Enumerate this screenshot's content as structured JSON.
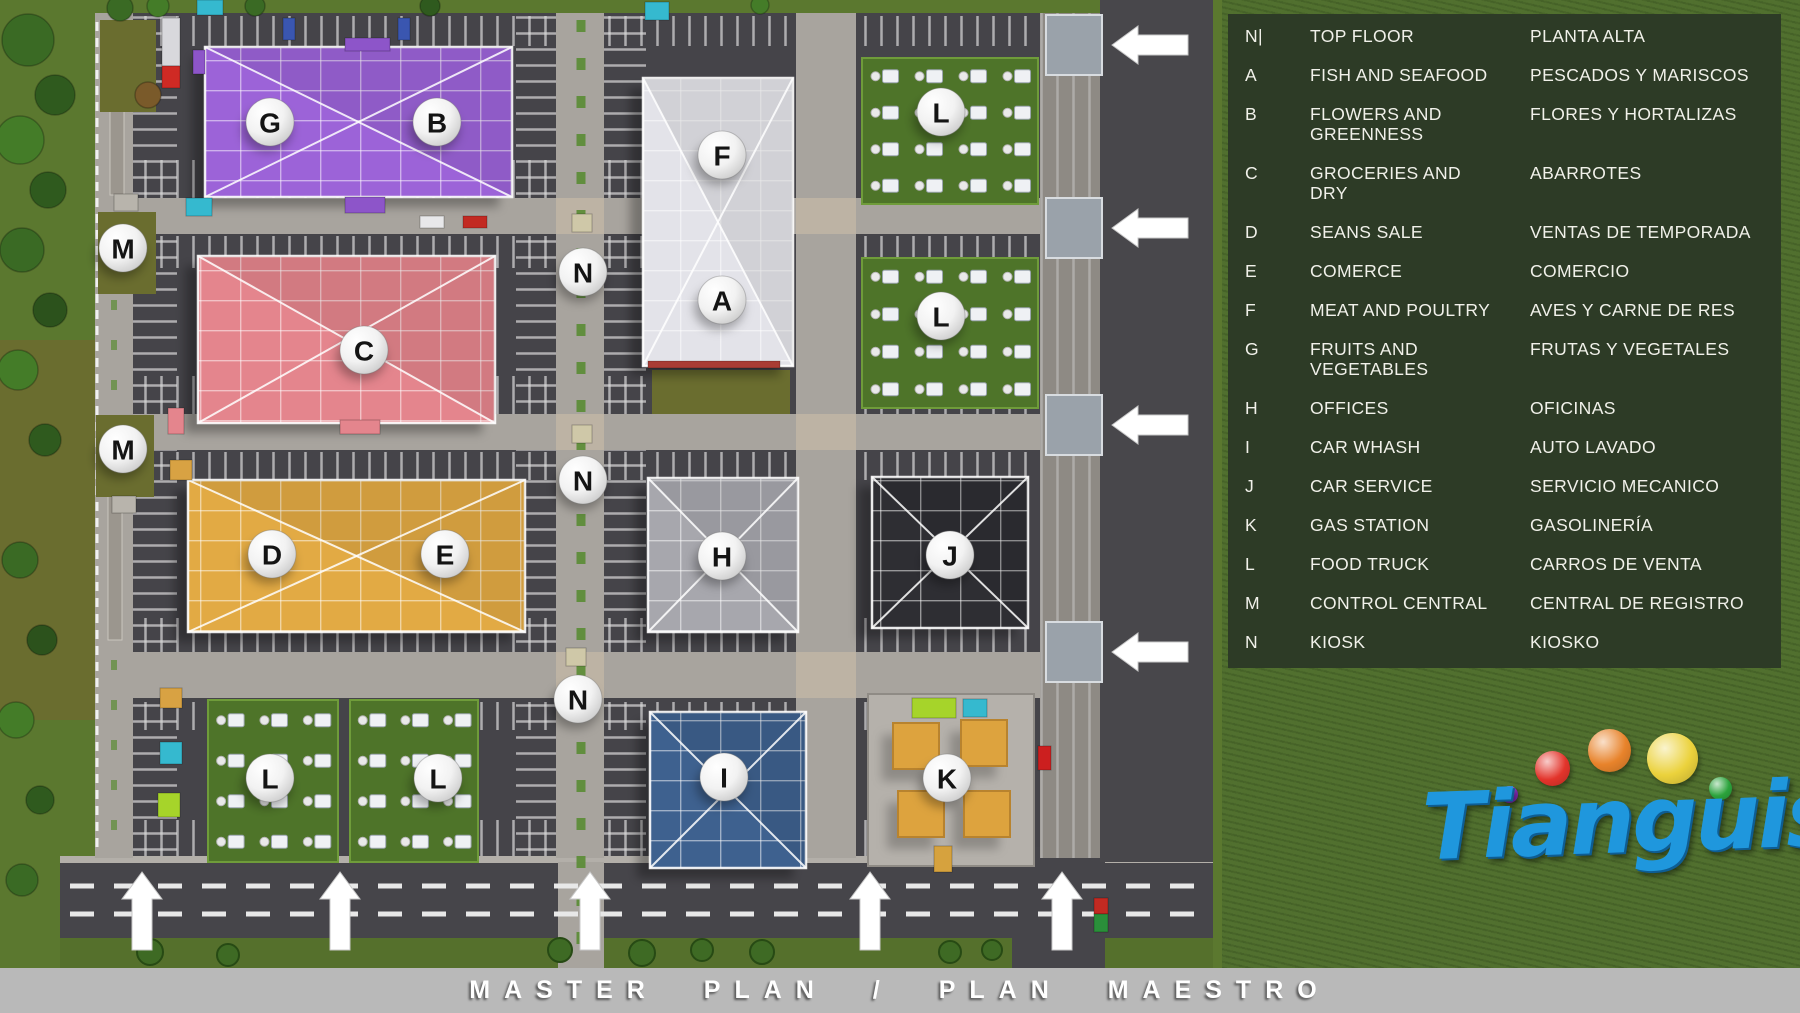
{
  "footer": {
    "title": "MASTER PLAN / PLAN MAESTRO",
    "bar_color": "#b9b9b9"
  },
  "legend": {
    "panel_color": "#2d3b26",
    "text_color": "#f1f1ea",
    "rows": [
      {
        "code": "N|",
        "en": "TOP FLOOR",
        "es": "PLANTA ALTA"
      },
      {
        "code": "A",
        "en": "FISH AND SEAFOOD",
        "es": "PESCADOS Y MARISCOS"
      },
      {
        "code": "B",
        "en": "FLOWERS AND\nGREENNESS",
        "es": "FLORES Y HORTALIZAS"
      },
      {
        "code": "C",
        "en": "GROCERIES AND\nDRY",
        "es": "ABARROTES"
      },
      {
        "code": "D",
        "en": "SEANS SALE",
        "es": "VENTAS DE TEMPORADA"
      },
      {
        "code": "E",
        "en": "COMERCE",
        "es": "COMERCIO"
      },
      {
        "code": "F",
        "en": "MEAT AND POULTRY",
        "es": "AVES Y CARNE DE RES"
      },
      {
        "code": "G",
        "en": "FRUITS AND\nVEGETABLES",
        "es": "FRUTAS Y VEGETALES"
      },
      {
        "code": "H",
        "en": "OFFICES",
        "es": "OFICINAS"
      },
      {
        "code": "I",
        "en": "CAR WHASH",
        "es": "AUTO LAVADO"
      },
      {
        "code": "J",
        "en": "CAR SERVICE",
        "es": "SERVICIO MECANICO"
      },
      {
        "code": "K",
        "en": "GAS STATION",
        "es": "GASOLINERÍA"
      },
      {
        "code": "L",
        "en": "FOOD TRUCK",
        "es": "CARROS DE VENTA"
      },
      {
        "code": "M",
        "en": "CONTROL CENTRAL",
        "es": "CENTRAL DE REGISTRO"
      },
      {
        "code": "N",
        "en": "KIOSK",
        "es": "KIOSKO"
      }
    ]
  },
  "logo": {
    "text": "Tianguis",
    "text_color": "#1f97dd",
    "dots": [
      {
        "name": "purple-dot",
        "color": "#8d2cc4"
      },
      {
        "name": "red-dot",
        "color": "#e3342b"
      },
      {
        "name": "orange-dot",
        "color": "#e8832b"
      },
      {
        "name": "yellow-dot",
        "color": "#ebd23c"
      },
      {
        "name": "green-dot",
        "color": "#2ba33c"
      }
    ]
  },
  "map": {
    "badges": [
      {
        "letter": "G",
        "x": 270,
        "y": 122
      },
      {
        "letter": "B",
        "x": 437,
        "y": 122
      },
      {
        "letter": "F",
        "x": 722,
        "y": 155
      },
      {
        "letter": "L",
        "x": 941,
        "y": 112
      },
      {
        "letter": "M",
        "x": 123,
        "y": 248
      },
      {
        "letter": "N",
        "x": 583,
        "y": 272
      },
      {
        "letter": "A",
        "x": 722,
        "y": 300
      },
      {
        "letter": "L",
        "x": 941,
        "y": 316
      },
      {
        "letter": "C",
        "x": 364,
        "y": 350
      },
      {
        "letter": "M",
        "x": 123,
        "y": 449
      },
      {
        "letter": "N",
        "x": 583,
        "y": 480
      },
      {
        "letter": "D",
        "x": 272,
        "y": 554
      },
      {
        "letter": "E",
        "x": 445,
        "y": 554
      },
      {
        "letter": "H",
        "x": 722,
        "y": 556
      },
      {
        "letter": "J",
        "x": 950,
        "y": 555
      },
      {
        "letter": "N",
        "x": 578,
        "y": 699
      },
      {
        "letter": "L",
        "x": 270,
        "y": 778
      },
      {
        "letter": "L",
        "x": 438,
        "y": 778
      },
      {
        "letter": "I",
        "x": 724,
        "y": 777
      },
      {
        "letter": "K",
        "x": 947,
        "y": 778
      }
    ],
    "buildings": [
      {
        "key": "G-B",
        "color": "#9c63d8",
        "x": 205,
        "y": 47,
        "w": 307,
        "h": 150
      },
      {
        "key": "C",
        "color": "#e4858d",
        "x": 198,
        "y": 256,
        "w": 297,
        "h": 167
      },
      {
        "key": "D-E",
        "color": "#e2aa44",
        "x": 188,
        "y": 480,
        "w": 337,
        "h": 152
      },
      {
        "key": "F-A",
        "color": "#e3e3e9",
        "x": 643,
        "y": 78,
        "w": 150,
        "h": 288
      },
      {
        "key": "H",
        "color": "#a7a7ad",
        "x": 648,
        "y": 478,
        "w": 150,
        "h": 154
      },
      {
        "key": "J",
        "color": "#2e2e33",
        "x": 872,
        "y": 477,
        "w": 156,
        "h": 151
      },
      {
        "key": "I",
        "color": "#3e618f",
        "x": 650,
        "y": 712,
        "w": 156,
        "h": 156
      }
    ],
    "truck_zones": [
      {
        "x": 862,
        "y": 58,
        "w": 176,
        "h": 146,
        "cols": 4,
        "rows": 4
      },
      {
        "x": 862,
        "y": 258,
        "w": 176,
        "h": 150,
        "cols": 4,
        "rows": 4
      },
      {
        "x": 208,
        "y": 700,
        "w": 130,
        "h": 162,
        "cols": 3,
        "rows": 4
      },
      {
        "x": 350,
        "y": 700,
        "w": 128,
        "h": 162,
        "cols": 3,
        "rows": 4
      }
    ],
    "gas_station": {
      "x": 868,
      "y": 694,
      "w": 166,
      "h": 172,
      "canopy_color": "#dda33e"
    },
    "arrows": {
      "right": [
        {
          "x": 1112,
          "y": 45
        },
        {
          "x": 1112,
          "y": 228
        },
        {
          "x": 1112,
          "y": 425
        },
        {
          "x": 1112,
          "y": 652
        }
      ],
      "bottom": [
        {
          "x": 142,
          "y": 950
        },
        {
          "x": 340,
          "y": 950
        },
        {
          "x": 590,
          "y": 950
        },
        {
          "x": 870,
          "y": 950
        },
        {
          "x": 1062,
          "y": 950
        }
      ]
    },
    "accents": [
      {
        "name": "delivery-truck-trailer",
        "x": 162,
        "y": 18,
        "w": 18,
        "h": 48,
        "color": "#d8d8dc"
      },
      {
        "name": "delivery-truck-cab",
        "x": 162,
        "y": 66,
        "w": 18,
        "h": 22,
        "color": "#cf2a24"
      },
      {
        "name": "teal-awning",
        "x": 197,
        "y": 0,
        "w": 26,
        "h": 15,
        "color": "#35b9cf"
      },
      {
        "name": "teal-awning",
        "x": 645,
        "y": 2,
        "w": 24,
        "h": 18,
        "color": "#35b9cf"
      },
      {
        "name": "teal-awning",
        "x": 186,
        "y": 198,
        "w": 26,
        "h": 18,
        "color": "#35b9cf"
      },
      {
        "name": "teal-awning",
        "x": 160,
        "y": 742,
        "w": 22,
        "h": 22,
        "color": "#35b9cf"
      },
      {
        "name": "lime-awning",
        "x": 158,
        "y": 793,
        "w": 22,
        "h": 24,
        "color": "#a6d42a"
      },
      {
        "name": "lime-canopy",
        "x": 912,
        "y": 698,
        "w": 44,
        "h": 20,
        "color": "#a6d42a"
      },
      {
        "name": "cyan-canopy",
        "x": 963,
        "y": 699,
        "w": 24,
        "h": 18,
        "color": "#35b9cf"
      },
      {
        "name": "purple-awning",
        "x": 345,
        "y": 38,
        "w": 45,
        "h": 13,
        "color": "#8d55c9"
      },
      {
        "name": "purple-awning",
        "x": 345,
        "y": 197,
        "w": 40,
        "h": 16,
        "color": "#8d55c9"
      },
      {
        "name": "purple-awning",
        "x": 193,
        "y": 50,
        "w": 12,
        "h": 24,
        "color": "#8d55c9"
      },
      {
        "name": "pink-awning",
        "x": 340,
        "y": 420,
        "w": 40,
        "h": 14,
        "color": "#e4858d"
      },
      {
        "name": "pink-awning",
        "x": 168,
        "y": 408,
        "w": 16,
        "h": 26,
        "color": "#e4858d"
      },
      {
        "name": "orange-awning",
        "x": 170,
        "y": 460,
        "w": 22,
        "h": 20,
        "color": "#d8a243"
      },
      {
        "name": "orange-awning",
        "x": 160,
        "y": 688,
        "w": 22,
        "h": 20,
        "color": "#d8a243"
      },
      {
        "name": "red-baseline",
        "x": 648,
        "y": 361,
        "w": 132,
        "h": 7,
        "color": "#a93c34"
      },
      {
        "name": "kiosk-hut",
        "x": 572,
        "y": 214,
        "w": 20,
        "h": 18,
        "color": "#cfc8a8"
      },
      {
        "name": "kiosk-hut",
        "x": 572,
        "y": 425,
        "w": 20,
        "h": 18,
        "color": "#cfc8a8"
      },
      {
        "name": "kiosk-hut",
        "x": 566,
        "y": 648,
        "w": 20,
        "h": 18,
        "color": "#cfc8a8"
      },
      {
        "name": "control-hut",
        "x": 114,
        "y": 194,
        "w": 24,
        "h": 17,
        "color": "#b8b4ac"
      },
      {
        "name": "control-hut",
        "x": 112,
        "y": 496,
        "w": 24,
        "h": 17,
        "color": "#b8b4ac"
      },
      {
        "name": "car",
        "x": 283,
        "y": 18,
        "w": 12,
        "h": 22,
        "color": "#3a56b0"
      },
      {
        "name": "car",
        "x": 398,
        "y": 18,
        "w": 12,
        "h": 22,
        "color": "#3a56b0"
      },
      {
        "name": "car",
        "x": 420,
        "y": 216,
        "w": 24,
        "h": 12,
        "color": "#e8e8ea"
      },
      {
        "name": "car",
        "x": 463,
        "y": 216,
        "w": 24,
        "h": 12,
        "color": "#c22a22"
      },
      {
        "name": "car",
        "x": 1038,
        "y": 746,
        "w": 13,
        "h": 24,
        "color": "#cc1f1f"
      },
      {
        "name": "service-truck",
        "x": 934,
        "y": 846,
        "w": 18,
        "h": 26,
        "color": "#d6a23e"
      },
      {
        "name": "truck-red",
        "x": 1094,
        "y": 898,
        "w": 14,
        "h": 16,
        "color": "#c22a22"
      },
      {
        "name": "truck-green",
        "x": 1094,
        "y": 914,
        "w": 14,
        "h": 18,
        "color": "#2a8f3a"
      }
    ],
    "olive_patches": [
      {
        "x": 100,
        "y": 20,
        "w": 56,
        "h": 92
      },
      {
        "x": 98,
        "y": 212,
        "w": 58,
        "h": 82
      },
      {
        "x": 96,
        "y": 415,
        "w": 58,
        "h": 82
      },
      {
        "x": 652,
        "y": 370,
        "w": 138,
        "h": 44
      }
    ],
    "trees": [
      {
        "x": 28,
        "y": 40,
        "r": 26,
        "color": "#3a6a24"
      },
      {
        "x": 55,
        "y": 95,
        "r": 20,
        "color": "#2f5a1e"
      },
      {
        "x": 20,
        "y": 140,
        "r": 24,
        "color": "#447c28"
      },
      {
        "x": 48,
        "y": 190,
        "r": 18,
        "color": "#2f5a1e"
      },
      {
        "x": 22,
        "y": 250,
        "r": 22,
        "color": "#3a6a24"
      },
      {
        "x": 50,
        "y": 310,
        "r": 17,
        "color": "#2c521c"
      },
      {
        "x": 18,
        "y": 370,
        "r": 20,
        "color": "#447c28"
      },
      {
        "x": 45,
        "y": 440,
        "r": 16,
        "color": "#2f5a1e"
      },
      {
        "x": 20,
        "y": 560,
        "r": 18,
        "color": "#3a6a24"
      },
      {
        "x": 42,
        "y": 640,
        "r": 15,
        "color": "#2c521c"
      },
      {
        "x": 16,
        "y": 720,
        "r": 18,
        "color": "#447c28"
      },
      {
        "x": 40,
        "y": 800,
        "r": 14,
        "color": "#2f5a1e"
      },
      {
        "x": 22,
        "y": 880,
        "r": 16,
        "color": "#3a6a24"
      },
      {
        "x": 120,
        "y": 8,
        "r": 13,
        "color": "#3a6a24"
      },
      {
        "x": 158,
        "y": 6,
        "r": 11,
        "color": "#447c28"
      },
      {
        "x": 255,
        "y": 6,
        "r": 10,
        "color": "#3a6a24"
      },
      {
        "x": 430,
        "y": 6,
        "r": 10,
        "color": "#2f5a1e"
      },
      {
        "x": 760,
        "y": 5,
        "r": 9,
        "color": "#447c28"
      },
      {
        "x": 148,
        "y": 95,
        "r": 13,
        "color": "#7a5a2a"
      }
    ],
    "palms": [
      {
        "x": 150,
        "y": 952,
        "r": 13
      },
      {
        "x": 228,
        "y": 955,
        "r": 11
      },
      {
        "x": 560,
        "y": 950,
        "r": 12
      },
      {
        "x": 642,
        "y": 953,
        "r": 13
      },
      {
        "x": 702,
        "y": 950,
        "r": 11
      },
      {
        "x": 762,
        "y": 952,
        "r": 12
      },
      {
        "x": 950,
        "y": 952,
        "r": 11
      },
      {
        "x": 992,
        "y": 950,
        "r": 10
      }
    ]
  }
}
